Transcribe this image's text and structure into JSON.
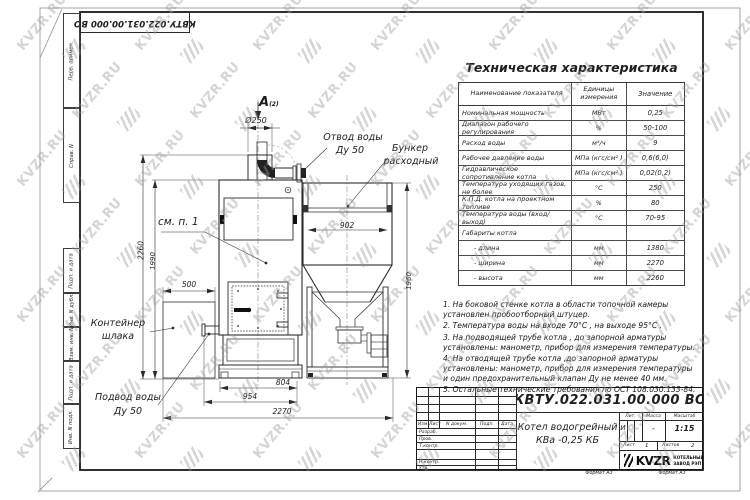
{
  "sheet": {
    "format_label": "Формат А3",
    "margin_labels": [
      "Перв. примен.",
      "Справ. N",
      "Подп. и дата",
      "Инв. N дубл.",
      "Взам. инв. N",
      "Подп. и дата",
      "Инв. N подл."
    ],
    "watermark_text": "KVZR.RU"
  },
  "spec_table": {
    "title": "Техническая характеристика",
    "col_headers": [
      "Наименование показателя",
      "Единицы измерения",
      "Значение"
    ],
    "rows": [
      [
        "Номинальная мощность",
        "МВт",
        "0,25"
      ],
      [
        "Диапазон рабочего регулирования",
        "%",
        "50-100"
      ],
      [
        "Расход воды",
        "м³/ч",
        "9"
      ],
      [
        "Рабочее давление воды",
        "МПа (кгс/см² )",
        "0,6(6,0)"
      ],
      [
        "Гидравлическое сопротивление котла",
        "МПа (кгс/см² )",
        "0,02(0,2)"
      ],
      [
        "Температура уходящих газов, не более",
        "°С",
        "250"
      ],
      [
        "К.П.Д. котла на проектном топливе",
        "%",
        "80"
      ],
      [
        "Температура воды (вход/выход)",
        "°С",
        "70-95"
      ],
      [
        "Габариты котла",
        "",
        ""
      ],
      [
        "  - длина",
        "мм",
        "1380"
      ],
      [
        "  - ширина",
        "мм",
        "2270"
      ],
      [
        "  - высота",
        "мм",
        "2260"
      ]
    ]
  },
  "notes": [
    "1.  На боковой стенке котла в области топочной камеры установлен пробоотборный штуцер.",
    "2.  Температура воды на входе  70°С , на выходе  95°С .",
    "3.  На подводящей трубе котла , до запорной арматуры установлены: манометр, прибор для измерения температуры.",
    "4.  На отводящей трубе котла ,до запорной арматуры установлены: манометр, прибор для измерения температуры и один предохранительный клапан Ду не менее  40 мм.",
    "5.  Остальные технические требования по ОСТ  108.030.133-84."
  ],
  "drawing": {
    "view_label": "А",
    "view_label_ref": "(2)",
    "labels": {
      "water_outlet_1": "Отвод воды",
      "water_outlet_2": "Ду 50",
      "hopper_1": "Бункер",
      "hopper_2": "расходный",
      "see_note": "см. п. 1",
      "slag_container_1": "Контейнер",
      "slag_container_2": "шлака",
      "water_inlet_1": "Подвод воды",
      "water_inlet_2": "Ду 50"
    },
    "dimensions": {
      "chimney_d": "Ø250",
      "height_total": "2260",
      "height_body": "1990",
      "container_w": "500",
      "hopper_w": "902",
      "hopper_h": "1960",
      "body_w": "804",
      "body_w2": "954",
      "total_w": "2270"
    }
  },
  "title_block": {
    "designation": "КВТУ.022.031.00.000  ВО",
    "product_name_1": "Котел водогрейный",
    "product_name_2": "КВа -0,25 КБ",
    "rev_headers": [
      "Изм.",
      "Лист",
      "N докум.",
      "Подп.",
      "Дата"
    ],
    "sign_rows": [
      "Разраб.",
      "Пров.",
      "Т.контр.",
      "Н.контр.",
      "Утв."
    ],
    "lit_label": "Лит.",
    "mass_label": "Масса",
    "scale_label": "Масштаб",
    "lit_value": "И",
    "mass_value": "-",
    "scale_value": "1:15",
    "sheet_label": "Лист",
    "sheet_value": "1",
    "sheets_label": "Листов",
    "sheets_value": "2",
    "logo_text": "KVZR",
    "company_1": "КОТЕЛЬНЫЙ",
    "company_2": "ЗАВОД РЭП"
  }
}
